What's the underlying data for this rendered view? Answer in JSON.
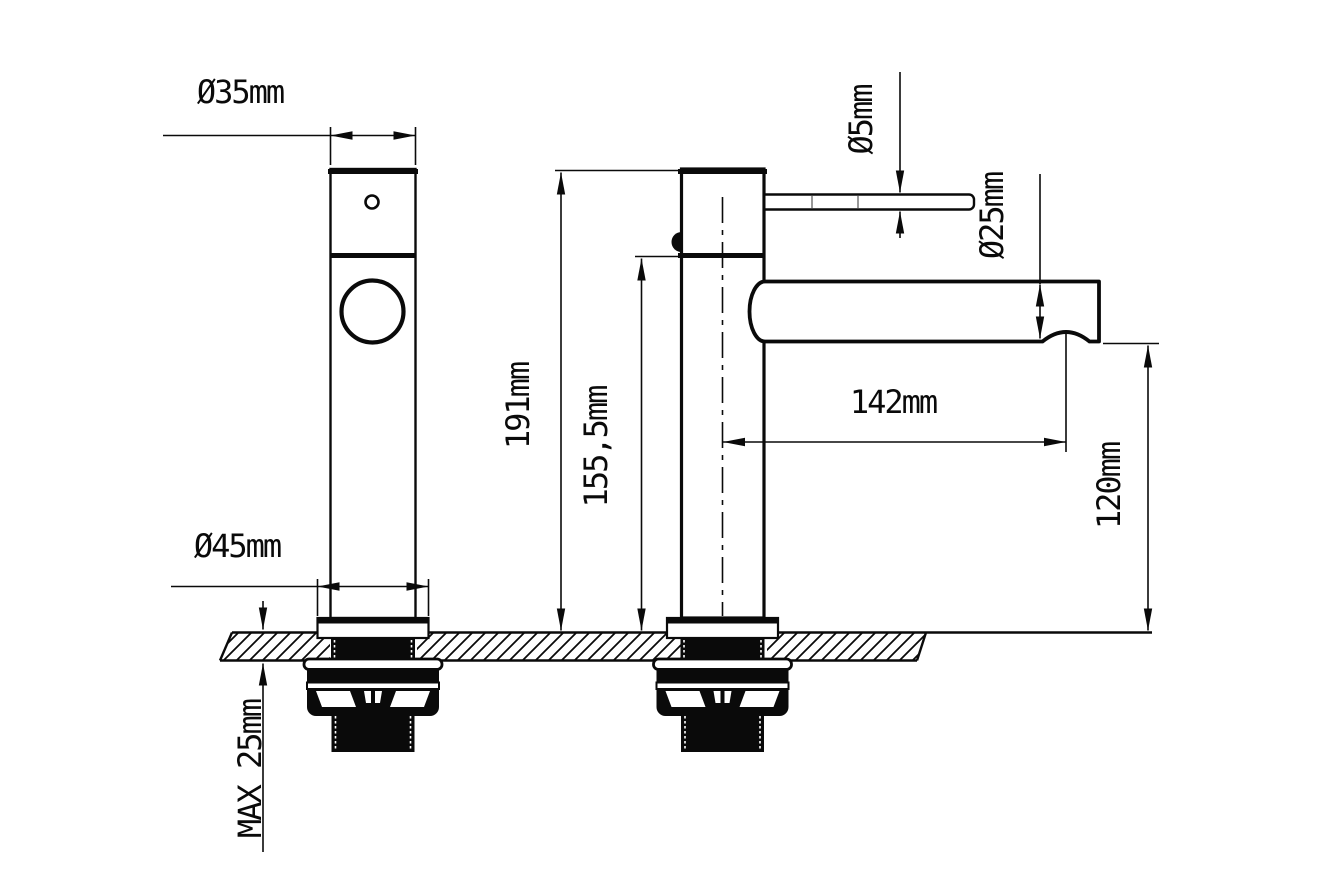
{
  "page": {
    "background": "#ffffff",
    "ink": "#0a0a0a",
    "kind": "technical dimension drawing",
    "subject": "single-lever basin mixer tap, front and side views with mounting cross-section"
  },
  "views": {
    "front": {
      "name": "front view"
    },
    "side": {
      "name": "side view"
    }
  },
  "dimensions": {
    "d35": {
      "label": "Ø35mm",
      "measures": "body diameter",
      "orientation": "horizontal"
    },
    "d45": {
      "label": "Ø45mm",
      "measures": "base flange diameter",
      "orientation": "horizontal"
    },
    "max25": {
      "label": "MAX 25mm",
      "measures": "deck thickness",
      "orientation": "vertical"
    },
    "d191": {
      "label": "191mm",
      "measures": "overall height",
      "orientation": "vertical"
    },
    "d1555": {
      "label": "155,5mm",
      "measures": "height to spout joint",
      "orientation": "vertical"
    },
    "d5": {
      "label": "Ø5mm",
      "measures": "lever rod diameter",
      "orientation": "vertical"
    },
    "d25": {
      "label": "Ø25mm",
      "measures": "spout diameter",
      "orientation": "vertical"
    },
    "d142": {
      "label": "142mm",
      "measures": "spout reach from centerline",
      "orientation": "horizontal"
    },
    "d120": {
      "label": "120mm",
      "measures": "outlet height above deck",
      "orientation": "vertical"
    }
  }
}
